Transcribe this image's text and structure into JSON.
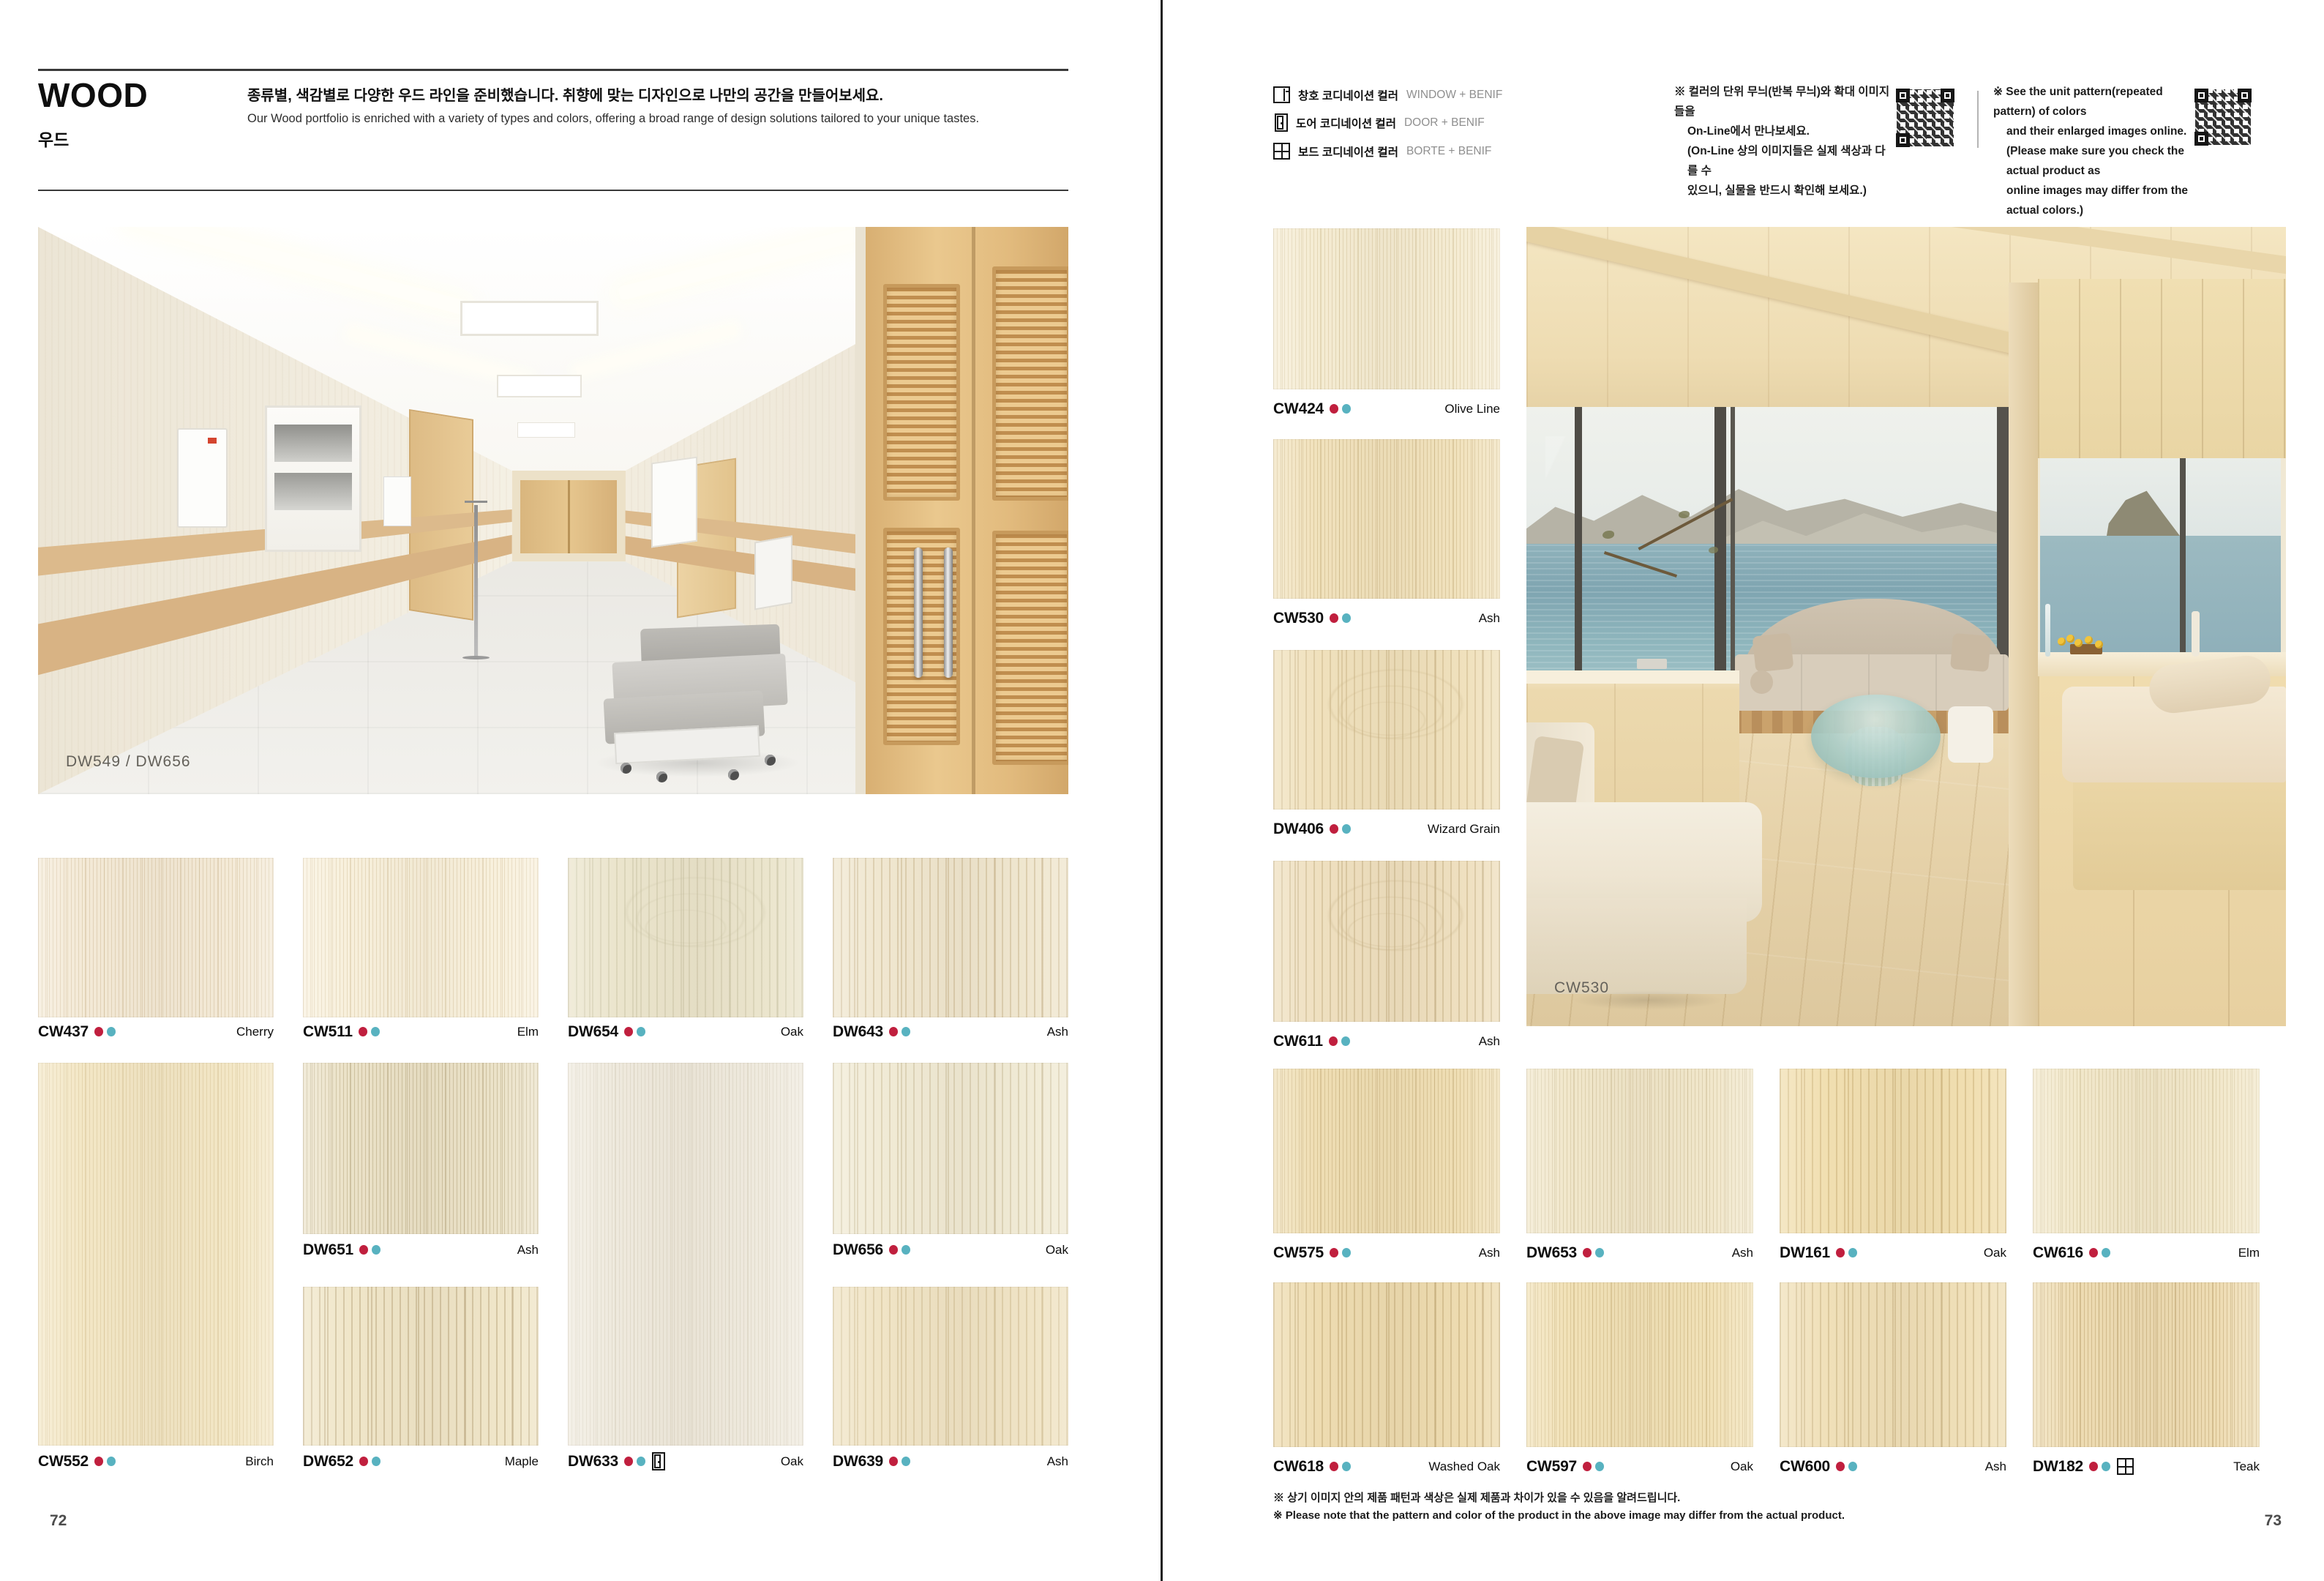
{
  "colors": {
    "dot_red": "#c01f3e",
    "dot_teal": "#58b2c0"
  },
  "left_page": {
    "page_number": "72",
    "title": "WOOD",
    "title_kr": "우드",
    "headline_kr": "종류별, 색감별로 다양한 우드 라인을 준비했습니다. 취향에 맞는 디자인으로 나만의 공간을 만들어보세요.",
    "headline_en": "Our Wood portfolio is enriched with a variety of types and colors, offering a broad range of design solutions tailored to your unique tastes.",
    "hero_caption": "DW549 / DW656",
    "swatches": [
      {
        "code": "CW437",
        "name": "Cherry",
        "base": "#f4ead7",
        "grain": "rgba(205,184,147,0.45)"
      },
      {
        "code": "CW511",
        "name": "Elm",
        "base": "#f8f0dc",
        "grain": "rgba(214,196,160,0.5)"
      },
      {
        "code": "DW654",
        "name": "Oak",
        "base": "#ebe5cd",
        "grain": "rgba(196,190,158,0.4)"
      },
      {
        "code": "DW643",
        "name": "Ash",
        "base": "#f0e7d0",
        "grain": "rgba(201,181,142,0.5)"
      },
      {
        "code": "DW651",
        "name": "Ash",
        "base": "#ebe2c8",
        "grain": "rgba(178,162,122,0.5)"
      },
      {
        "code": "DW656",
        "name": "Oak",
        "base": "#f1ebd6",
        "grain": "rgba(198,184,148,0.45)"
      },
      {
        "code": "CW552",
        "name": "Birch",
        "base": "#f3e7c6",
        "grain": "rgba(213,192,146,0.45)"
      },
      {
        "code": "DW652",
        "name": "Maple",
        "base": "#f0e6c9",
        "grain": "rgba(186,166,126,0.5)"
      },
      {
        "code": "DW633",
        "name": "Oak",
        "base": "#efeade",
        "grain": "rgba(206,198,178,0.4)",
        "icon": "door"
      },
      {
        "code": "DW639",
        "name": "Ash",
        "base": "#f0e4c6",
        "grain": "rgba(203,183,139,0.45)"
      }
    ]
  },
  "right_page": {
    "page_number": "73",
    "legend": [
      {
        "icon": "window",
        "kr": "창호 코디네이션 컬러",
        "en": "WINDOW + BENIF"
      },
      {
        "icon": "door",
        "kr": "도어 코디네이션 컬러",
        "en": "DOOR + BENIF"
      },
      {
        "icon": "board",
        "kr": "보드 코디네이션 컬러",
        "en": "BORTE + BENIF"
      }
    ],
    "note_kr": [
      "※ 컬러의 단위 무늬(반복 무늬)와 확대 이미지들을",
      "On-Line에서 만나보세요.",
      "(On-Line 상의 이미지들은 실제 색상과 다를 수",
      "있으니, 실물을 반드시 확인해 보세요.)"
    ],
    "note_en": [
      "※ See the unit pattern(repeated pattern) of colors",
      "and their enlarged images online.",
      "(Please make sure you check the actual product as",
      "online images may differ from the actual colors.)"
    ],
    "hero_caption": "CW530",
    "column_swatches": [
      {
        "code": "CW424",
        "name": "Olive Line",
        "base": "#f5ecd3",
        "grain": "rgba(207,189,146,0.45)"
      },
      {
        "code": "CW530",
        "name": "Ash",
        "base": "#f1e2bd",
        "grain": "rgba(200,177,128,0.5)"
      },
      {
        "code": "DW406",
        "name": "Wizard Grain",
        "base": "#f0e1bd",
        "grain": "rgba(199,177,131,0.45)"
      },
      {
        "code": "CW611",
        "name": "Ash",
        "base": "#efe0c0",
        "grain": "rgba(197,176,133,0.5)"
      }
    ],
    "grid_swatches": [
      {
        "code": "CW575",
        "name": "Ash",
        "base": "#efdeb4",
        "grain": "rgba(196,172,120,0.5)"
      },
      {
        "code": "DW653",
        "name": "Ash",
        "base": "#f1e7cb",
        "grain": "rgba(199,183,143,0.45)"
      },
      {
        "code": "DW161",
        "name": "Oak",
        "base": "#f1dfb1",
        "grain": "rgba(202,176,120,0.5)"
      },
      {
        "code": "CW616",
        "name": "Elm",
        "base": "#f2e8cb",
        "grain": "rgba(204,188,146,0.45)"
      },
      {
        "code": "CW618",
        "name": "Washed Oak",
        "base": "#eedcb1",
        "grain": "rgba(193,168,117,0.5)"
      },
      {
        "code": "CW597",
        "name": "Oak",
        "base": "#f1e1b7",
        "grain": "rgba(201,177,124,0.5)"
      },
      {
        "code": "CW600",
        "name": "Ash",
        "base": "#f0e0b9",
        "grain": "rgba(198,176,128,0.5)"
      },
      {
        "code": "DW182",
        "name": "Teak",
        "base": "#eedcb3",
        "grain": "rgba(190,164,112,0.55)",
        "icon": "board"
      }
    ],
    "footnote_kr": "※ 상기 이미지 안의 제품 패턴과 색상은 실제 제품과 차이가 있을 수 있음을 알려드립니다.",
    "footnote_en": "※ Please note that the pattern and color of the product in the above image may differ from the actual product."
  }
}
